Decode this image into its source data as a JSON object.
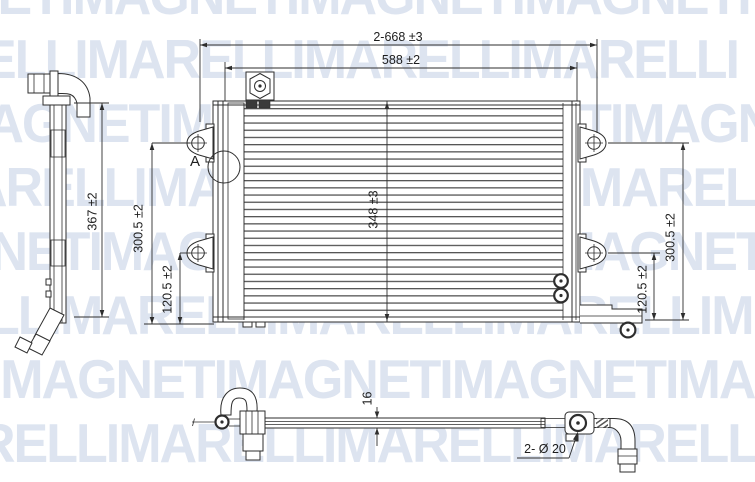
{
  "drawing": {
    "title_hint": "condenser technical drawing, three orthographic views",
    "detail_label": "A",
    "dimensions": {
      "overall_width": "2-668 ±3",
      "core_width": "588 ±2",
      "side_height": "367 ±2",
      "left_bracket_upper": "300.5 ±2",
      "left_bracket_lower": "120.5 ±2",
      "core_height": "348 ±3",
      "right_bracket_upper": "300.5 ±2",
      "right_bracket_lower": "120.5 ±2",
      "thickness": "16",
      "mounting_holes": "2- Ø 20"
    },
    "line_color": "#2e2e2e"
  },
  "watermark": {
    "brand": "MAGNETI MARELLI",
    "color": "#dde4f0",
    "rows": [
      {
        "text": "NETIMAGNETIMAGNETIMAGNETI",
        "x": -38,
        "y": -30
      },
      {
        "text": "ELLIMARELLIMARELLIMARELLI",
        "x": -18,
        "y": 34
      },
      {
        "text": "MAGNETIMAGNETIMAGNETIMAGN",
        "x": -55,
        "y": 98
      },
      {
        "text": "ARELLIMARELLIMARELLIMAREL",
        "x": -30,
        "y": 162
      },
      {
        "text": "GNETIMAGNETIMAGNETIMAGNET",
        "x": -48,
        "y": 226
      },
      {
        "text": "LLIMARELLIMARELLIMARELLIM",
        "x": -12,
        "y": 290
      },
      {
        "text": "TIMAGNETIMAGNETIMAGNETIMA",
        "x": -42,
        "y": 354
      },
      {
        "text": "RELLIMARELLIMARELLIMARELL",
        "x": -22,
        "y": 418
      }
    ]
  }
}
